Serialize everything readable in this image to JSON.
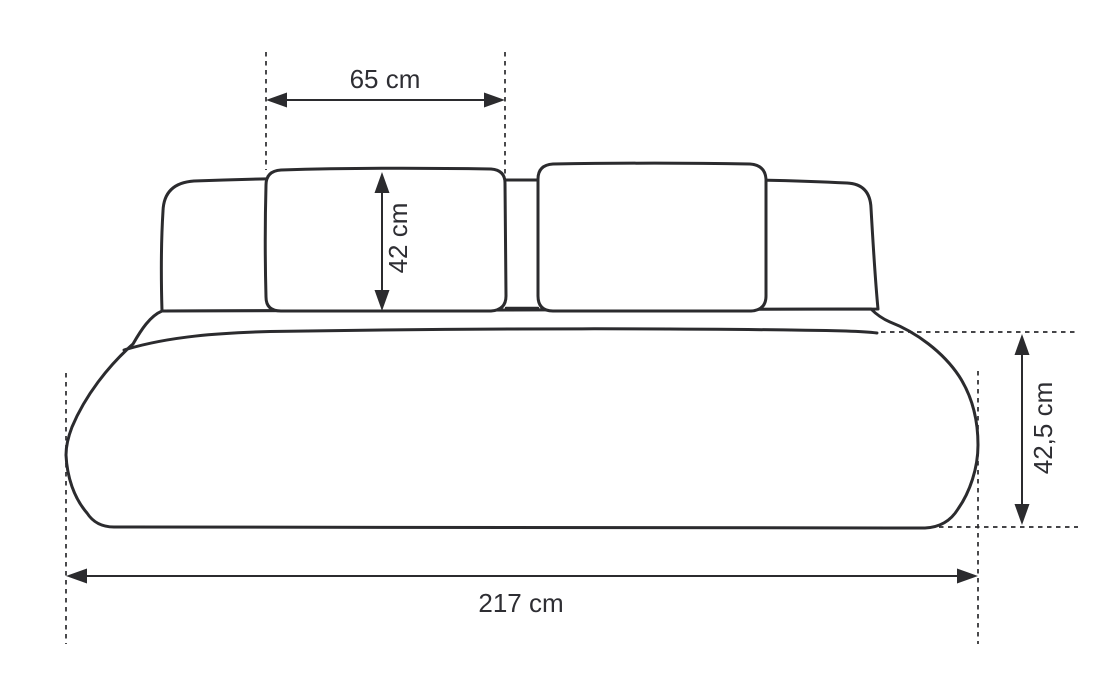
{
  "meta": {
    "background_color": "#ffffff",
    "line_color": "#2b2b2e",
    "text_color": "#2e2e33"
  },
  "diagram": {
    "subject": "sofa-front-view-dimension-drawing",
    "dimensions": {
      "cushion_width": {
        "label": "65 cm",
        "orientation": "horizontal"
      },
      "cushion_height": {
        "label": "42 cm",
        "orientation": "vertical"
      },
      "base_height": {
        "label": "42,5 cm",
        "orientation": "vertical"
      },
      "total_width": {
        "label": "217 cm",
        "orientation": "horizontal"
      }
    }
  }
}
